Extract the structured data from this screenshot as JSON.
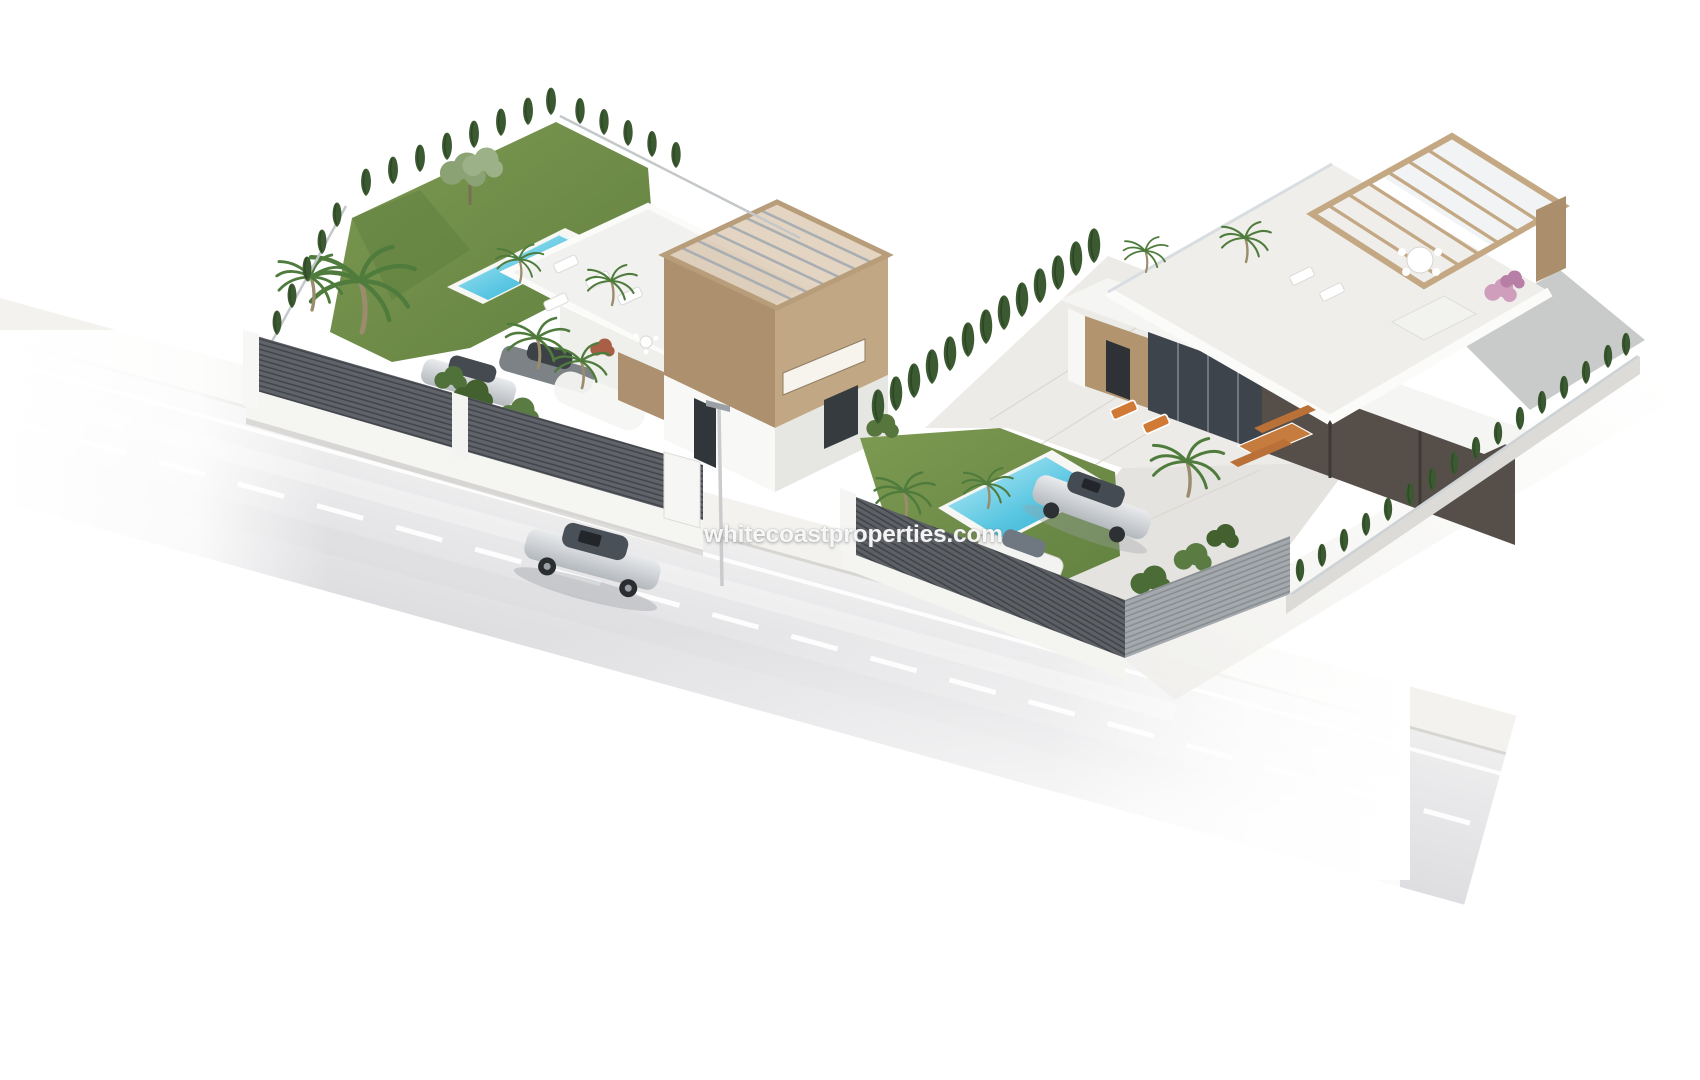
{
  "meta": {
    "kind": "3D architectural exterior render",
    "view": "aerial isometric view of two detached villas on an L-shaped corner plot",
    "background": "#ffffff"
  },
  "watermark": {
    "text": "whitecoastproperties.com",
    "color": "#ffffff"
  },
  "palette": {
    "background": "#ffffff",
    "sidewalk": "#f3f2ee",
    "road_light": "#ededef",
    "road_dark": "#dfdfe2",
    "lane_marking": "#ffffff",
    "lawn": "#73914a",
    "lawn_dark": "#5d7b3b",
    "cypress": "#3c5a31",
    "pool_water": "#2fb3d8",
    "pool_water_light": "#bfeef8",
    "pool_deck": "#f6f6f3",
    "fence_dark": "#5d6165",
    "fence_light": "#a2a7ac",
    "wall_white": "#f8f8f6",
    "wall_shade": "#e6e6e3",
    "wood_tan": "#c2a784",
    "wood_tan_dark": "#ad916f",
    "wood_furniture": "#c6803f",
    "facade_dark": "#564f49",
    "glass_dark": "#3d444c",
    "car_silver": "#c8ccd0",
    "terrace_stone": "#ecebe7"
  },
  "scene": {
    "road": {
      "surface": "light asphalt street running diagonally, fading to white at edges",
      "markings": [
        "solid white edge line",
        "dashed white center line"
      ],
      "sidewalk": "pale paved sidewalk along plot fences",
      "vehicle": "silver sedan driving along the street",
      "streetlight": "slim street lamp post on sidewalk"
    },
    "left_villa": {
      "style": "modern white villa with flat roof terrace",
      "roof": "roof terrace with white sun loungers and potted palm",
      "tower": "tan upper volume topped by pergola beams with slot window",
      "pool": "rectangular blue pool with white deck beside lawn",
      "garden": [
        "large lawn",
        "olive tree",
        "tall palm trees",
        "cypress trees along boundary"
      ],
      "fence": "dark grey louvre fence with white piers and white gate",
      "parking": "silver car and grey car parked behind street fence"
    },
    "right_villa": {
      "style": "modern white single-storey villa with large roof terrace",
      "pergola": "light wood pergola on the upper roof corner",
      "roof_furniture": [
        "round white dining table with chairs",
        "sun loungers",
        "white lounge sofa",
        "potted palms",
        "pink bougainvillea"
      ],
      "terrace_furniture": [
        "two orange-cushion sun loungers",
        "wooden dining table with benches"
      ],
      "facade": [
        "wood-clad entrance",
        "dark glass sliding doors",
        "dark bronze garage volume"
      ],
      "pool": "rectangular blue pool set in lawn",
      "garden": [
        "lawn",
        "palm trees",
        "tall cypress hedge on left boundary",
        "low hedge with glass fence on right boundary"
      ],
      "fence": "dark grey louvre street fence meeting lighter fence at corner",
      "parking": "silver coupe and white car in driveway behind fence"
    }
  }
}
